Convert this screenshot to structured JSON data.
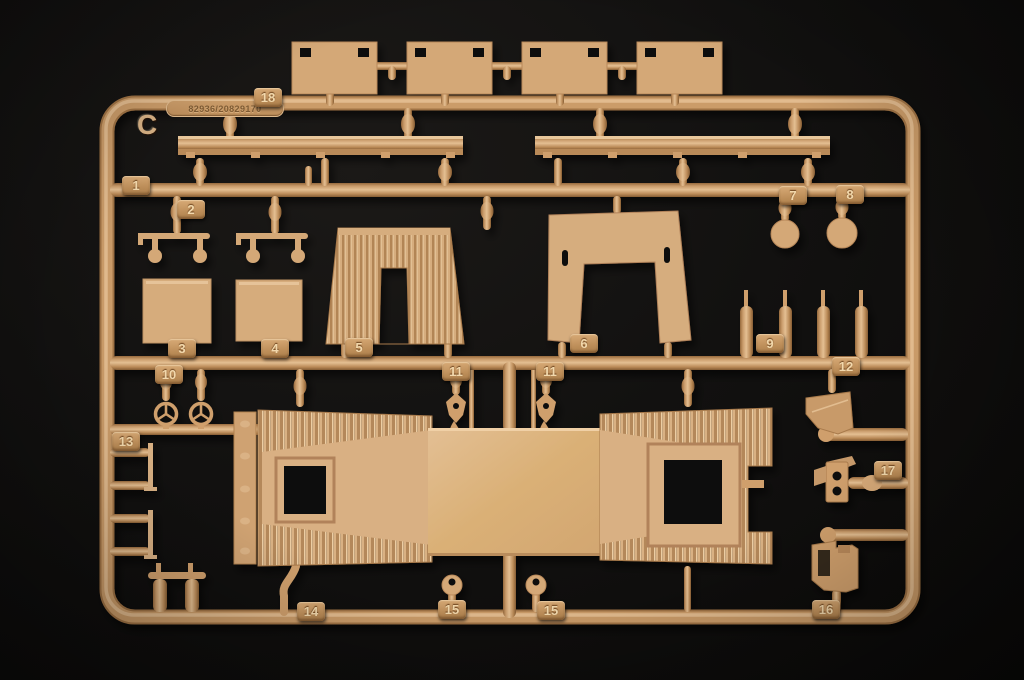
{
  "photo": {
    "subject": "plastic-model-kit-sprue",
    "sprue_letter": "C",
    "mold_number": "82936/20829170",
    "background_color": "#0c0b0a",
    "plastic_color": "#cf9f6c",
    "plastic_light": "#dcb486",
    "tag_text_color": "#f2d8ac"
  },
  "tags": {
    "t18": "18",
    "t1": "1",
    "t2": "2",
    "t3": "3",
    "t4": "4",
    "t5": "5",
    "t6": "6",
    "t7": "7",
    "t8": "8",
    "t9": "9",
    "t10": "10",
    "t11a": "11",
    "t11b": "11",
    "t12": "12",
    "t13": "13",
    "t14": "14",
    "t15a": "15",
    "t15b": "15",
    "t16": "16",
    "t17": "17"
  }
}
